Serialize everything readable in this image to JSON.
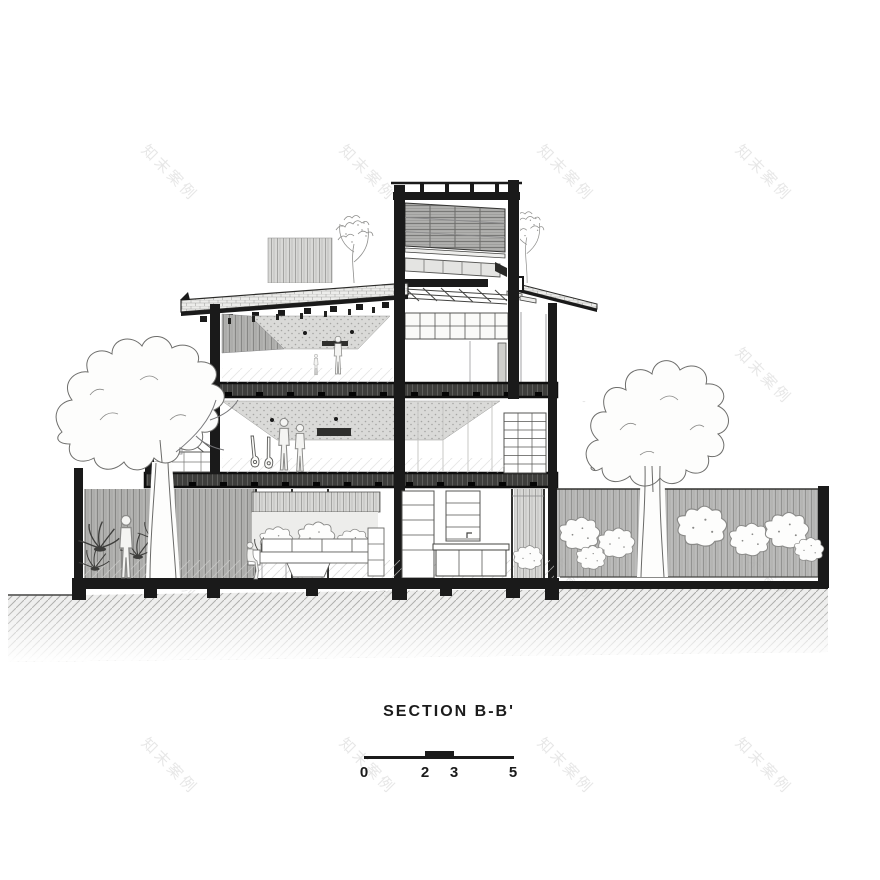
{
  "title": {
    "text": "SECTION B-B'"
  },
  "scale_bar": {
    "labels": [
      "0",
      "2",
      "3",
      "5"
    ]
  },
  "watermark": {
    "text": "知末案例"
  },
  "colors": {
    "ink": "#1a1a1a",
    "paper": "#ffffff",
    "watermark_gray": "#e7e7e7",
    "slab_gray": "#3e3e3c",
    "hatch_gray": "#9b9b9b"
  },
  "drawing": {
    "kind": "architectural cross-section",
    "depicts": [
      "three-storey house cut section",
      "rooftop louvre and skylight tower",
      "tiled pitched roofs with rafter tails",
      "third-floor room with adult and child",
      "second-floor living space with couple and two guitars",
      "left dormer bay with sloped skylight",
      "ground-floor living room with seated person, sofa and plant wall",
      "kitchen island and shelving",
      "left courtyard garden with standing person, ferns and tree",
      "right garden with large tree, shrubs and boundary wall",
      "foundation footings and hatched ground"
    ]
  }
}
